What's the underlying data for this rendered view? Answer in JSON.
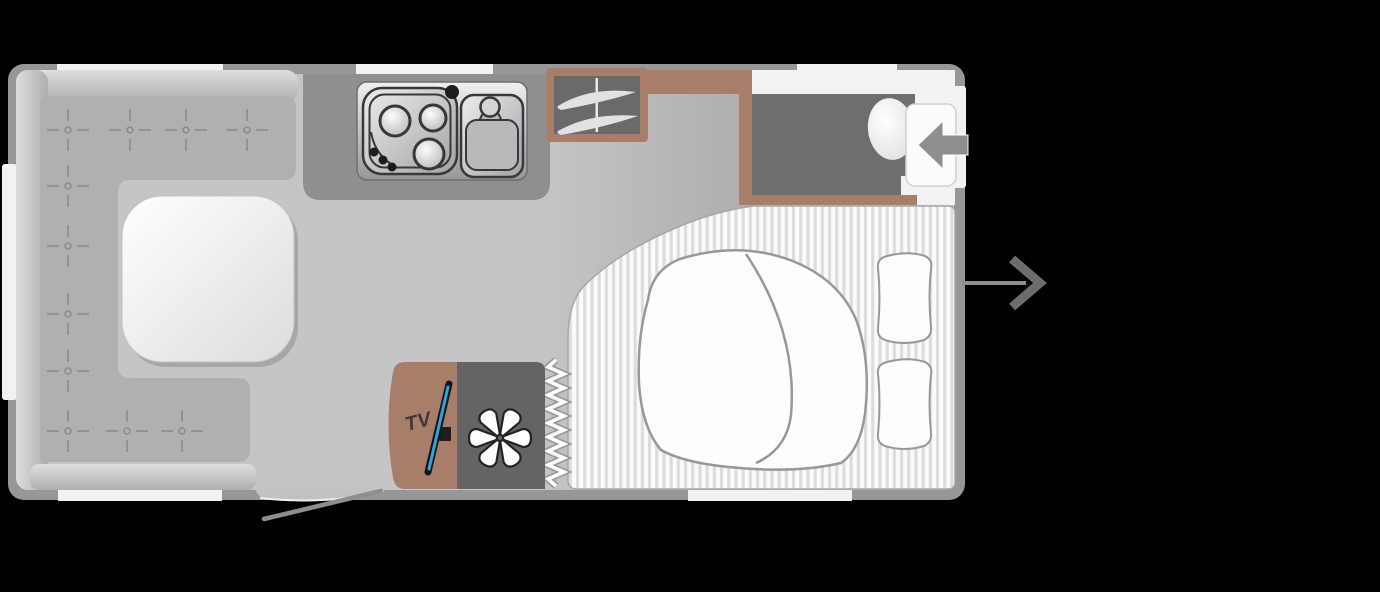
{
  "title": "Caravan floor plan",
  "labels": {
    "tv": "TV"
  },
  "icons": {
    "heater_fan": "✳",
    "washroom_door_arrow": "←",
    "exit_arrow": "→",
    "wardrobe_rail": "hanging-rail",
    "upholstery_button": "+"
  },
  "colors": {
    "background": "#000000",
    "wall": "#97979a",
    "floor": "#c5c5c7",
    "window": "#f2f2f4",
    "seat": "#b0b0b2",
    "seat_back": "#c9c9cb",
    "table": "#f7f7f9",
    "kitchen_counter": "#8f8f91",
    "furniture_brown": "#a87e6a",
    "dark_unit": "#6a6a6c",
    "shower_floor": "#6e6e70",
    "heater": "#646466",
    "bedding": "#fdfdfe",
    "mattress_stripe": "#dcdcde",
    "tv_screen_accent": "#2ba7d9",
    "arrow": "#8e8e90",
    "arrow_dark": "#6c6c6e"
  },
  "floorplan": {
    "vehicle": "caravan",
    "areas": {
      "lounge": {
        "name": "front lounge",
        "features": [
          "u-shaped-seating",
          "table",
          "upholstery-buttons"
        ]
      },
      "kitchen": {
        "name": "kitchen",
        "features": [
          "three-burner-hob",
          "sink-with-tap",
          "worktop"
        ]
      },
      "wardrobe": {
        "name": "wardrobe",
        "features": [
          "hanging-rail"
        ]
      },
      "washroom": {
        "name": "washroom",
        "features": [
          "shower-floor",
          "toilet",
          "door-with-entry-arrow"
        ]
      },
      "bedroom": {
        "name": "double bed",
        "features": [
          "striped-mattress",
          "duvet",
          "two-pillows",
          "curtain-divider"
        ]
      },
      "tv_unit": {
        "name": "tv cabinet",
        "label": "TV"
      },
      "heater": {
        "name": "blown-air-heater",
        "icon": "asterisk"
      },
      "entrance": {
        "name": "entrance door",
        "features": [
          "open-door-swing",
          "step"
        ]
      },
      "exit_marker": {
        "name": "door position arrow",
        "icon": "right-arrow"
      }
    }
  }
}
